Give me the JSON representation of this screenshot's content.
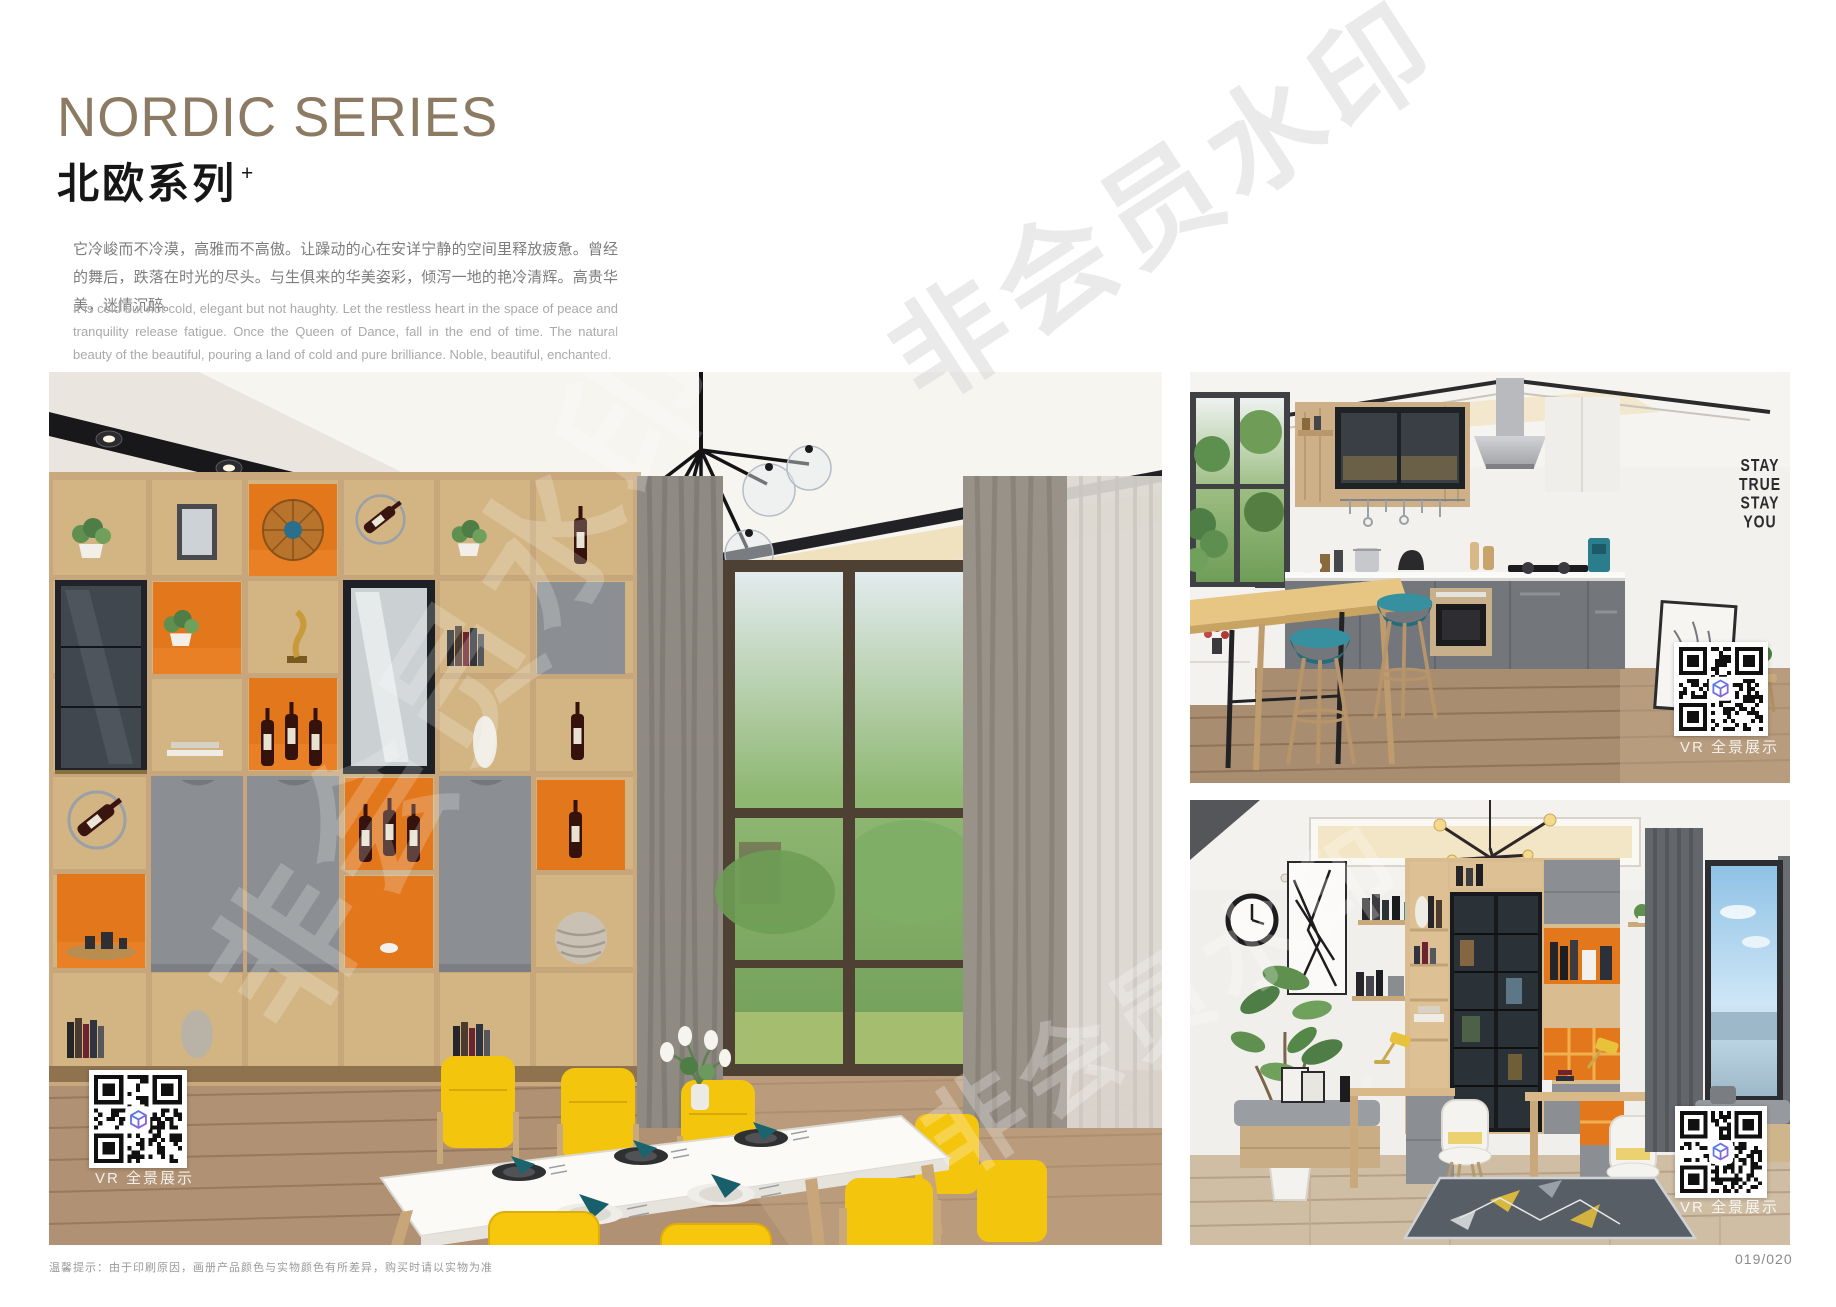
{
  "header": {
    "title_en": "NORDIC SERIES",
    "title_cn": "北欧系列",
    "title_sup": "+",
    "paragraph_cn": "它冷峻而不冷漠，高雅而不高傲。让躁动的心在安详宁静的空间里释放疲惫。曾经的舞后，跌落在时光的尽头。与生俱来的华美姿彩，倾泻一地的艳冷清辉。高贵华美，迷情沉醉。",
    "paragraph_en": "It is cold but not cold, elegant but not haughty. Let the restless heart in the space of peace and tranquility release fatigue. Once the Queen of Dance, fall in the end of time. The natural beauty of the beautiful, pouring a land of cold and pure brilliance. Noble, beautiful, enchanted."
  },
  "photos": {
    "dining": {
      "name": "dining-room-scene",
      "vr_label": "VR 全景展示"
    },
    "kitchen": {
      "name": "kitchen-scene",
      "vr_label": "VR 全景展示",
      "wall_text_lines": [
        "STAY",
        "TRUE",
        "STAY",
        "YOU"
      ]
    },
    "study": {
      "name": "study-room-scene",
      "vr_label": "VR 全景展示"
    }
  },
  "watermark": {
    "text": "非会员水印"
  },
  "footer": {
    "note": "温馨提示：由于印刷原因，画册产品颜色与实物颜色有所差异，购买时请以实物为准",
    "page_number": "019/020"
  },
  "colors": {
    "title_brown": "#8c7a63",
    "accent_orange": "#e2771c",
    "cabinet_gray": "#8b8f93",
    "shelf_wood": "#d9bc8f",
    "chair_yellow": "#f5c60c",
    "stool_teal": "#2a7f8d",
    "qr_logo_blue": "#4a7fe8",
    "qr_logo_purple": "#9a5fd8"
  }
}
